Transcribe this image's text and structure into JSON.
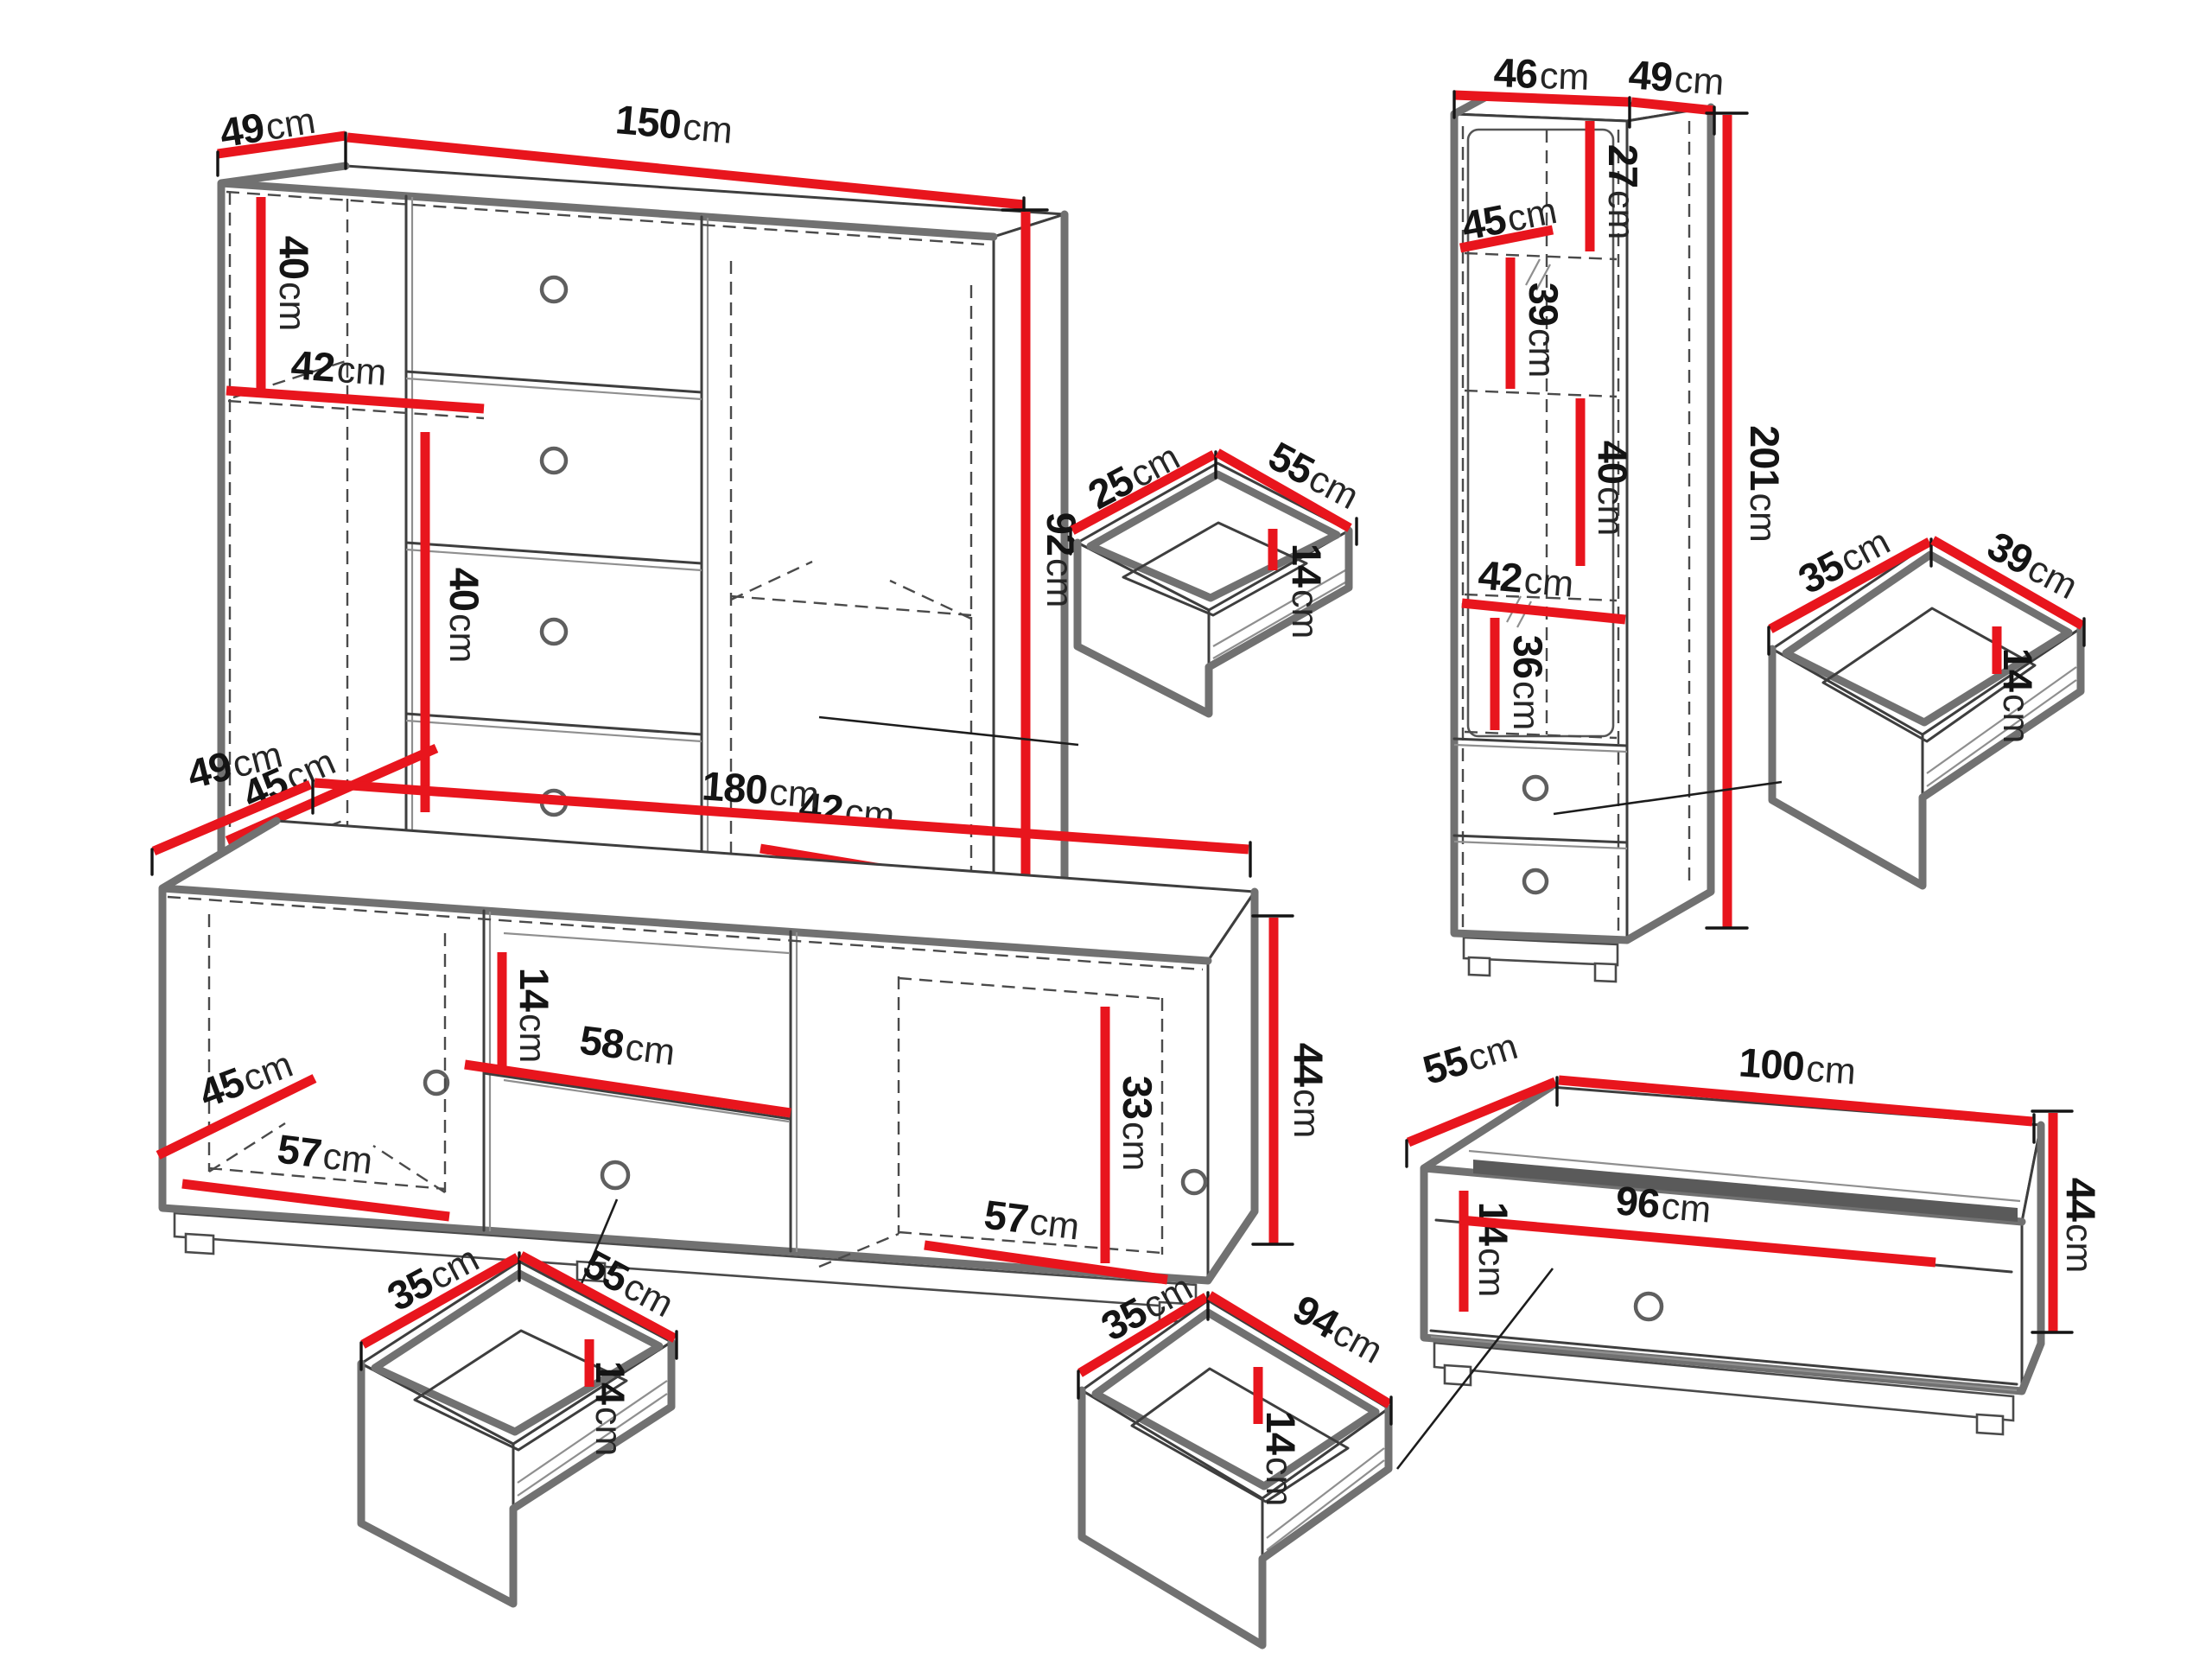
{
  "unit": "cm",
  "palette": {
    "dimension_red": "#e8151d",
    "outline_dark": "#3e3e3e",
    "outline_soft": "#717171",
    "text_black": "#141414"
  },
  "pieces": {
    "sideboard": {
      "depth": "49",
      "width": "150",
      "height": "92",
      "upper_section": "40",
      "shelf_width": "42",
      "lower_section": "40",
      "door_floor": "45",
      "right_floor": "42"
    },
    "drawer_mid": {
      "depth": "25",
      "width": "55",
      "height": "14"
    },
    "tall_cabinet": {
      "width": "46",
      "depth": "49",
      "height": "201",
      "top_section": "27",
      "glass_floor": "45",
      "mid_section": "39",
      "lower_section": "40",
      "inner_width": "42",
      "bottom_section": "36"
    },
    "drawer_right": {
      "depth": "35",
      "width": "39",
      "height": "14"
    },
    "tv_stand": {
      "depth": "49",
      "width": "180",
      "height": "44",
      "door_floor": "45",
      "left_floor": "57",
      "niche_height": "14",
      "niche_width": "58",
      "right_section": "33",
      "right_floor": "57"
    },
    "drawer_left": {
      "depth": "35",
      "width": "55",
      "height": "14"
    },
    "drawer_wide": {
      "depth": "35",
      "width": "94",
      "height": "14"
    },
    "bench": {
      "depth": "55",
      "width": "100",
      "height": "44",
      "niche_height": "14",
      "inner_width": "96"
    }
  }
}
